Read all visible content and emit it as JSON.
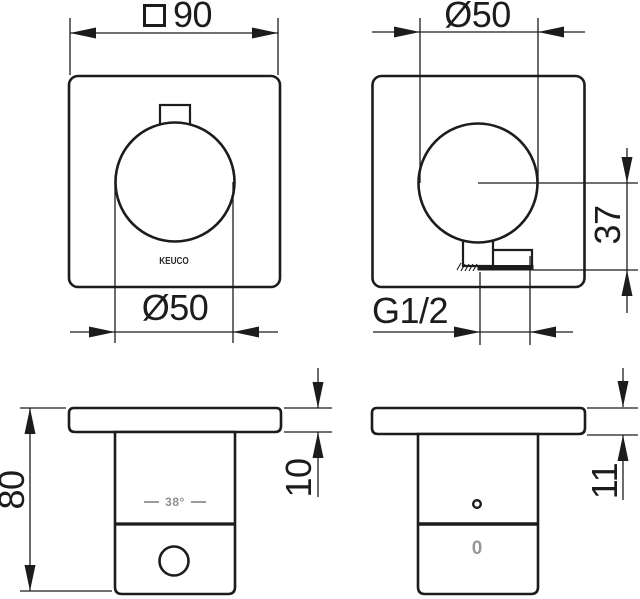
{
  "drawing": {
    "brand": "KEUCO",
    "views": {
      "front_panel": {
        "width_dim": "90",
        "knob_dim": "Ø50",
        "brand": "KEUCO"
      },
      "front_panel_outlet": {
        "knob_dim": "Ø50",
        "thread_dim": "G1/2",
        "outlet_offset_dim": "37"
      },
      "side_thermostat": {
        "height_dim": "80",
        "plate_thickness_dim": "10",
        "temperature_marking": "38°"
      },
      "side_valve": {
        "plate_thickness_dim": "11",
        "scale_marking": "0"
      }
    },
    "colors": {
      "line": "#1c1c1c",
      "muted_marking": "#8f8f8f",
      "background": "#ffffff"
    }
  }
}
